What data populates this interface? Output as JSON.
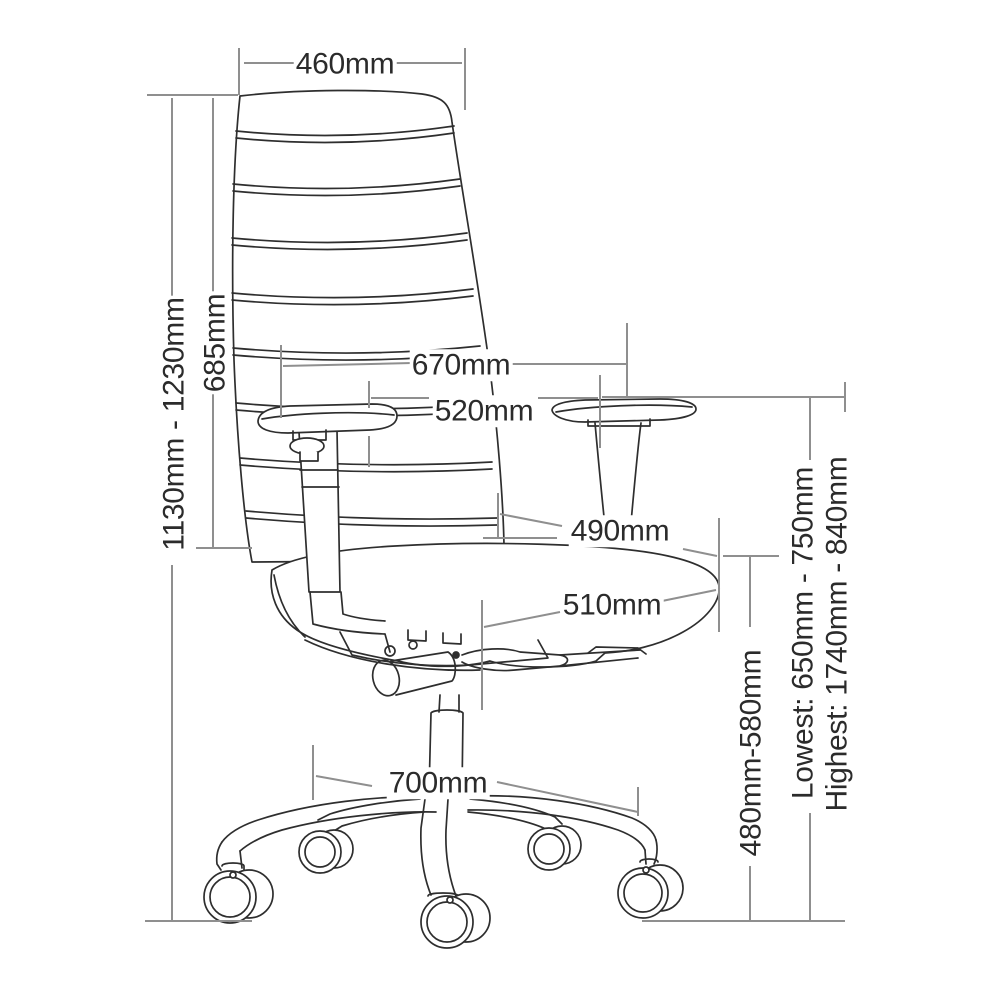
{
  "diagram": {
    "subject": "office chair dimension drawing",
    "unit": "mm",
    "labels": {
      "back_width": "460mm",
      "back_height": "685mm",
      "overall_height": "1130mm - 1230mm",
      "overall_width": "670mm",
      "seat_width": "520mm",
      "seat_depth": "490mm",
      "seat_front_width": "510mm",
      "base_diameter": "700mm",
      "seat_height_range": "480mm-580mm",
      "armrest_lowest": "Lowest: 650mm - 750mm",
      "armrest_highest": "Highest: 1740mm - 840mm"
    },
    "colors": {
      "background": "#ffffff",
      "line_art": "#2e2e2e",
      "dimension_lines": "#8f8f8f",
      "text": "#2b2b2b"
    }
  }
}
